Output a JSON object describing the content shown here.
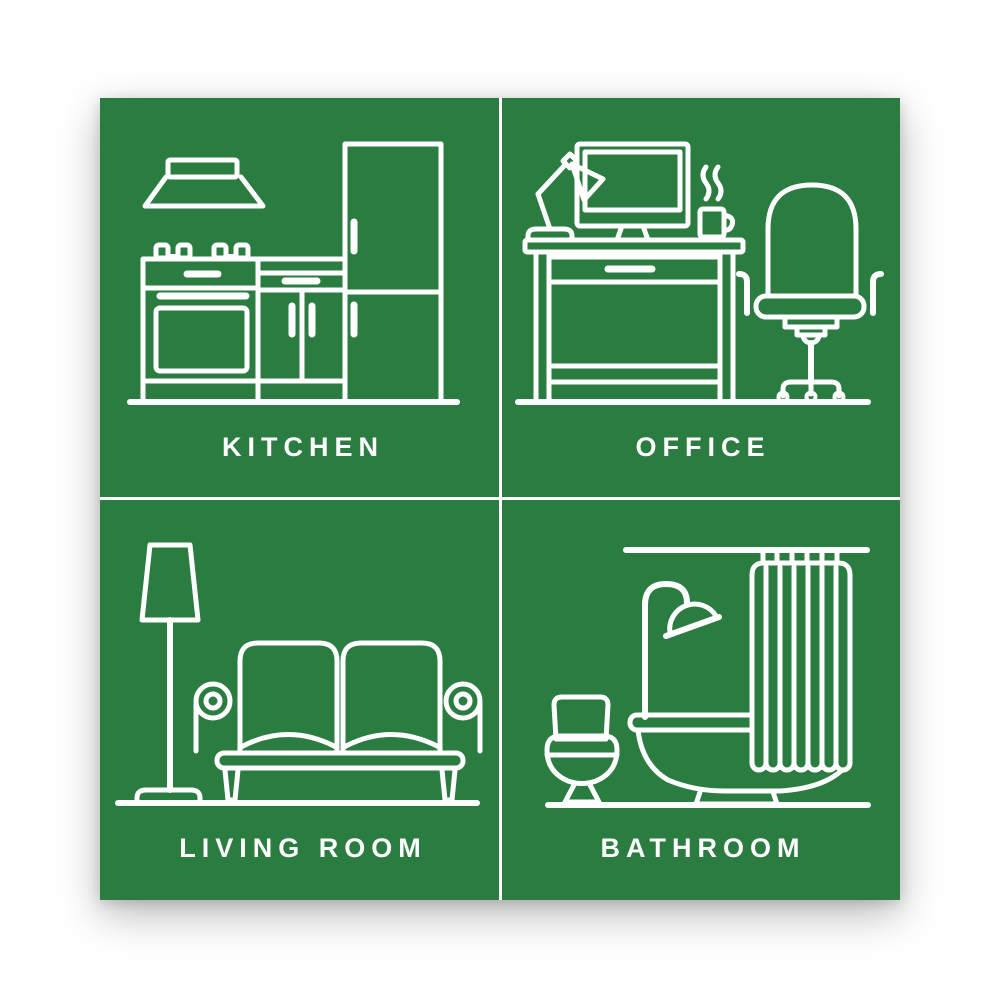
{
  "poster": {
    "background_color": "#2b7c41",
    "line_color": "#ffffff",
    "page_background": "#ffffff",
    "layout": "2x2-grid",
    "panels": [
      {
        "id": "kitchen",
        "label": "KITCHEN",
        "icons": [
          "range-hood-icon",
          "stove-icon",
          "cabinet-icon",
          "refrigerator-icon"
        ]
      },
      {
        "id": "office",
        "label": "OFFICE",
        "icons": [
          "desk-lamp-icon",
          "monitor-icon",
          "coffee-mug-icon",
          "desk-icon",
          "office-chair-icon"
        ]
      },
      {
        "id": "living-room",
        "label": "LIVING ROOM",
        "icons": [
          "floor-lamp-icon",
          "sofa-icon"
        ]
      },
      {
        "id": "bathroom",
        "label": "BATHROOM",
        "icons": [
          "shower-rod-icon",
          "shower-curtain-icon",
          "shower-head-icon",
          "bathtub-icon",
          "toilet-icon"
        ]
      }
    ]
  }
}
